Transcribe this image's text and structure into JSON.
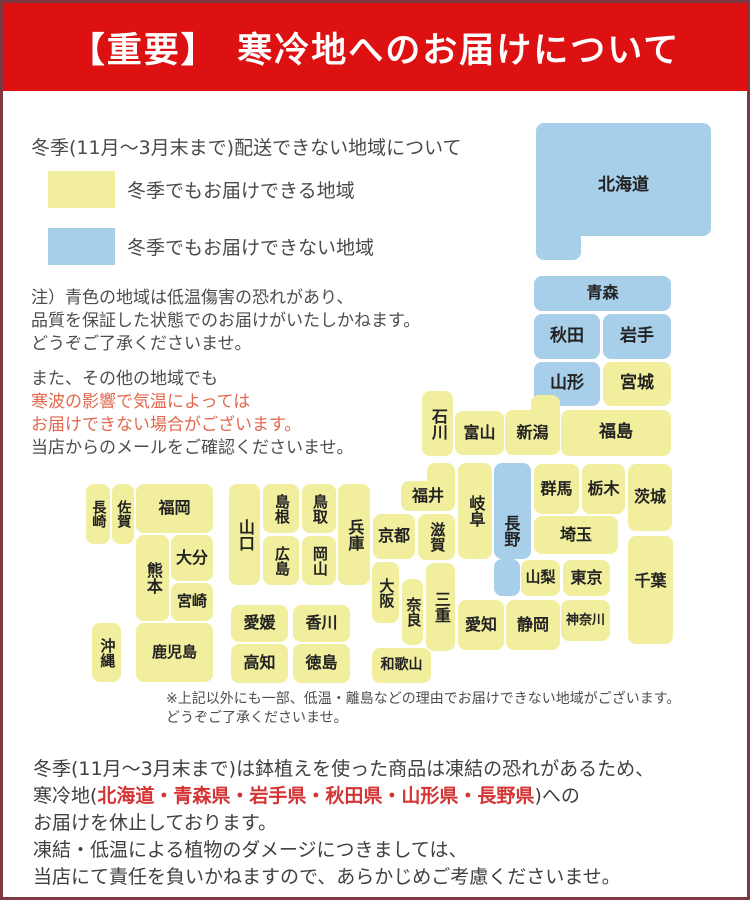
{
  "banner": {
    "text": "【重要】　寒冷地へのお届けについて",
    "bg": "#dd1111",
    "text_color": "#ffffff"
  },
  "intro": {
    "heading": "冬季(11月〜3月末まで)配送できない地域について",
    "legend": [
      {
        "color": "#f1ee9d",
        "label": "冬季でもお届けできる地域"
      },
      {
        "color": "#a7cfe9",
        "label": "冬季でもお届けできない地域"
      }
    ]
  },
  "notes": {
    "note1_lines": [
      "注）青色の地域は低温傷害の恐れがあり、",
      "品質を保証した状態でのお届けがいたしかねます。",
      "どうぞご了承くださいませ。"
    ],
    "note2_line1": "また、その他の地域でも",
    "note2_red_lines": [
      "寒波の影響で気温によっては",
      "お届けできない場合がございます。"
    ],
    "note2_line4": "当店からのメールをご確認くださいませ。",
    "red_color": "#e2684e"
  },
  "map": {
    "colors": {
      "deliverable": "#f1ee9d",
      "not_deliverable": "#a7cfe9"
    },
    "prefectures": [
      {
        "name": "北海道",
        "status": "not_deliverable",
        "rects": [
          [
            533,
            120,
            175,
            113
          ],
          [
            533,
            218,
            45,
            39
          ]
        ],
        "label": [
          533,
          130,
          175,
          105
        ],
        "size": 17
      },
      {
        "name": "青森",
        "status": "not_deliverable",
        "rects": [
          [
            531,
            273,
            137,
            35
          ]
        ],
        "size": 16
      },
      {
        "name": "秋田",
        "status": "not_deliverable",
        "rects": [
          [
            531,
            311,
            66,
            45
          ]
        ],
        "size": 17
      },
      {
        "name": "岩手",
        "status": "not_deliverable",
        "rects": [
          [
            600,
            311,
            68,
            45
          ]
        ],
        "size": 17
      },
      {
        "name": "山形",
        "status": "not_deliverable",
        "rects": [
          [
            531,
            359,
            66,
            44
          ]
        ],
        "size": 17
      },
      {
        "name": "宮城",
        "status": "deliverable",
        "rects": [
          [
            600,
            359,
            68,
            44
          ]
        ],
        "size": 17
      },
      {
        "name": "新潟",
        "status": "deliverable",
        "rects": [
          [
            528,
            392,
            29,
            60
          ],
          [
            502,
            407,
            55,
            45
          ]
        ],
        "label": [
          502,
          409,
          55,
          43
        ],
        "size": 16
      },
      {
        "name": "福島",
        "status": "deliverable",
        "rects": [
          [
            558,
            407,
            110,
            46
          ]
        ],
        "size": 17
      },
      {
        "name": "富山",
        "status": "deliverable",
        "rects": [
          [
            452,
            408,
            49,
            44
          ]
        ],
        "size": 16
      },
      {
        "name": "石川",
        "status": "deliverable",
        "rects": [
          [
            419,
            388,
            31,
            65
          ]
        ],
        "v": true,
        "size": 16
      },
      {
        "name": "群馬",
        "status": "deliverable",
        "rects": [
          [
            531,
            461,
            45,
            50
          ]
        ],
        "size": 16
      },
      {
        "name": "栃木",
        "status": "deliverable",
        "rects": [
          [
            579,
            461,
            43,
            50
          ]
        ],
        "size": 16
      },
      {
        "name": "茨城",
        "status": "deliverable",
        "rects": [
          [
            625,
            461,
            44,
            67
          ]
        ],
        "size": 16
      },
      {
        "name": "埼玉",
        "status": "deliverable",
        "rects": [
          [
            531,
            513,
            84,
            38
          ]
        ],
        "size": 16
      },
      {
        "name": "長野",
        "status": "not_deliverable",
        "rects": [
          [
            491,
            460,
            37,
            96
          ],
          [
            491,
            556,
            26,
            37
          ]
        ],
        "label": [
          493,
          478,
          28,
          100
        ],
        "v": true,
        "size": 16
      },
      {
        "name": "山梨",
        "status": "deliverable",
        "rects": [
          [
            518,
            557,
            39,
            36
          ]
        ],
        "size": 15
      },
      {
        "name": "東京",
        "status": "deliverable",
        "rects": [
          [
            560,
            557,
            47,
            36
          ]
        ],
        "size": 16
      },
      {
        "name": "千葉",
        "status": "deliverable",
        "rects": [
          [
            625,
            533,
            45,
            108
          ]
        ],
        "label": [
          625,
          556,
          45,
          44
        ],
        "size": 16
      },
      {
        "name": "神奈川",
        "status": "deliverable",
        "rects": [
          [
            558,
            597,
            49,
            41
          ]
        ],
        "size": 13
      },
      {
        "name": "静岡",
        "status": "deliverable",
        "rects": [
          [
            503,
            597,
            54,
            50
          ]
        ],
        "size": 16
      },
      {
        "name": "愛知",
        "status": "deliverable",
        "rects": [
          [
            455,
            597,
            46,
            50
          ]
        ],
        "size": 16
      },
      {
        "name": "岐阜",
        "status": "deliverable",
        "rects": [
          [
            455,
            460,
            34,
            96
          ]
        ],
        "v": true,
        "size": 16
      },
      {
        "name": "福井",
        "status": "deliverable",
        "rects": [
          [
            424,
            460,
            28,
            48
          ],
          [
            398,
            478,
            54,
            30
          ]
        ],
        "label": [
          398,
          479,
          54,
          29
        ],
        "size": 16
      },
      {
        "name": "滋賀",
        "status": "deliverable",
        "rects": [
          [
            415,
            511,
            37,
            46
          ]
        ],
        "v": true,
        "size": 15
      },
      {
        "name": "京都",
        "status": "deliverable",
        "rects": [
          [
            370,
            511,
            42,
            45
          ]
        ],
        "size": 16
      },
      {
        "name": "三重",
        "status": "deliverable",
        "rects": [
          [
            423,
            560,
            29,
            88
          ]
        ],
        "v": true,
        "size": 16
      },
      {
        "name": "大阪",
        "status": "deliverable",
        "rects": [
          [
            369,
            559,
            27,
            61
          ]
        ],
        "v": true,
        "size": 15
      },
      {
        "name": "奈良",
        "status": "deliverable",
        "rects": [
          [
            399,
            576,
            21,
            66
          ]
        ],
        "v": true,
        "size": 15
      },
      {
        "name": "和歌山",
        "status": "deliverable",
        "rects": [
          [
            369,
            645,
            59,
            35
          ]
        ],
        "size": 14
      },
      {
        "name": "兵庫",
        "status": "deliverable",
        "rects": [
          [
            335,
            481,
            32,
            101
          ]
        ],
        "v": true,
        "size": 16
      },
      {
        "name": "鳥取",
        "status": "deliverable",
        "rects": [
          [
            299,
            481,
            34,
            49
          ]
        ],
        "v": true,
        "size": 15
      },
      {
        "name": "島根",
        "status": "deliverable",
        "rects": [
          [
            260,
            481,
            36,
            49
          ]
        ],
        "v": true,
        "size": 15
      },
      {
        "name": "岡山",
        "status": "deliverable",
        "rects": [
          [
            299,
            533,
            34,
            49
          ]
        ],
        "v": true,
        "size": 15
      },
      {
        "name": "広島",
        "status": "deliverable",
        "rects": [
          [
            260,
            533,
            36,
            49
          ]
        ],
        "v": true,
        "size": 15
      },
      {
        "name": "山口",
        "status": "deliverable",
        "rects": [
          [
            226,
            481,
            31,
            101
          ]
        ],
        "v": true,
        "size": 16
      },
      {
        "name": "香川",
        "status": "deliverable",
        "rects": [
          [
            290,
            602,
            57,
            37
          ]
        ],
        "size": 16
      },
      {
        "name": "愛媛",
        "status": "deliverable",
        "rects": [
          [
            228,
            602,
            57,
            37
          ]
        ],
        "size": 16
      },
      {
        "name": "徳島",
        "status": "deliverable",
        "rects": [
          [
            290,
            641,
            57,
            39
          ]
        ],
        "size": 16
      },
      {
        "name": "高知",
        "status": "deliverable",
        "rects": [
          [
            228,
            641,
            57,
            39
          ]
        ],
        "size": 16
      },
      {
        "name": "福岡",
        "status": "deliverable",
        "rects": [
          [
            133,
            481,
            77,
            49
          ]
        ],
        "size": 16
      },
      {
        "name": "佐賀",
        "status": "deliverable",
        "rects": [
          [
            109,
            481,
            22,
            60
          ]
        ],
        "v": true,
        "size": 14
      },
      {
        "name": "長崎",
        "status": "deliverable",
        "rects": [
          [
            83,
            481,
            24,
            60
          ]
        ],
        "v": true,
        "size": 14
      },
      {
        "name": "熊本",
        "status": "deliverable",
        "rects": [
          [
            133,
            532,
            33,
            86
          ]
        ],
        "v": true,
        "size": 16
      },
      {
        "name": "大分",
        "status": "deliverable",
        "rects": [
          [
            168,
            532,
            42,
            46
          ]
        ],
        "size": 16
      },
      {
        "name": "宮崎",
        "status": "deliverable",
        "rects": [
          [
            168,
            580,
            42,
            38
          ]
        ],
        "size": 15
      },
      {
        "name": "鹿児島",
        "status": "deliverable",
        "rects": [
          [
            133,
            620,
            77,
            59
          ]
        ],
        "size": 15
      },
      {
        "name": "沖縄",
        "status": "deliverable",
        "rects": [
          [
            89,
            620,
            29,
            59
          ]
        ],
        "v": true,
        "size": 15
      }
    ]
  },
  "footnote": {
    "line1": "※上記以外にも一部、低温・離島などの理由でお届けできない地域がございます。",
    "line2": "どうぞご了承くださいませ。"
  },
  "footer": {
    "line1": "冬季(11月〜3月末まで)は鉢植えを使った商品は凍結の恐れがあるため、",
    "line2_prefix": "寒冷地(",
    "line2_red": "北海道・青森県・岩手県・秋田県・山形県・長野県",
    "line2_suffix": ")への",
    "line3": "お届けを休止しております。",
    "line4": "凍結・低温による植物のダメージにつきましては、",
    "line5": "当店にて責任を負いかねますので、あらかじめご考慮くださいませ。",
    "red_color": "#d43434"
  }
}
